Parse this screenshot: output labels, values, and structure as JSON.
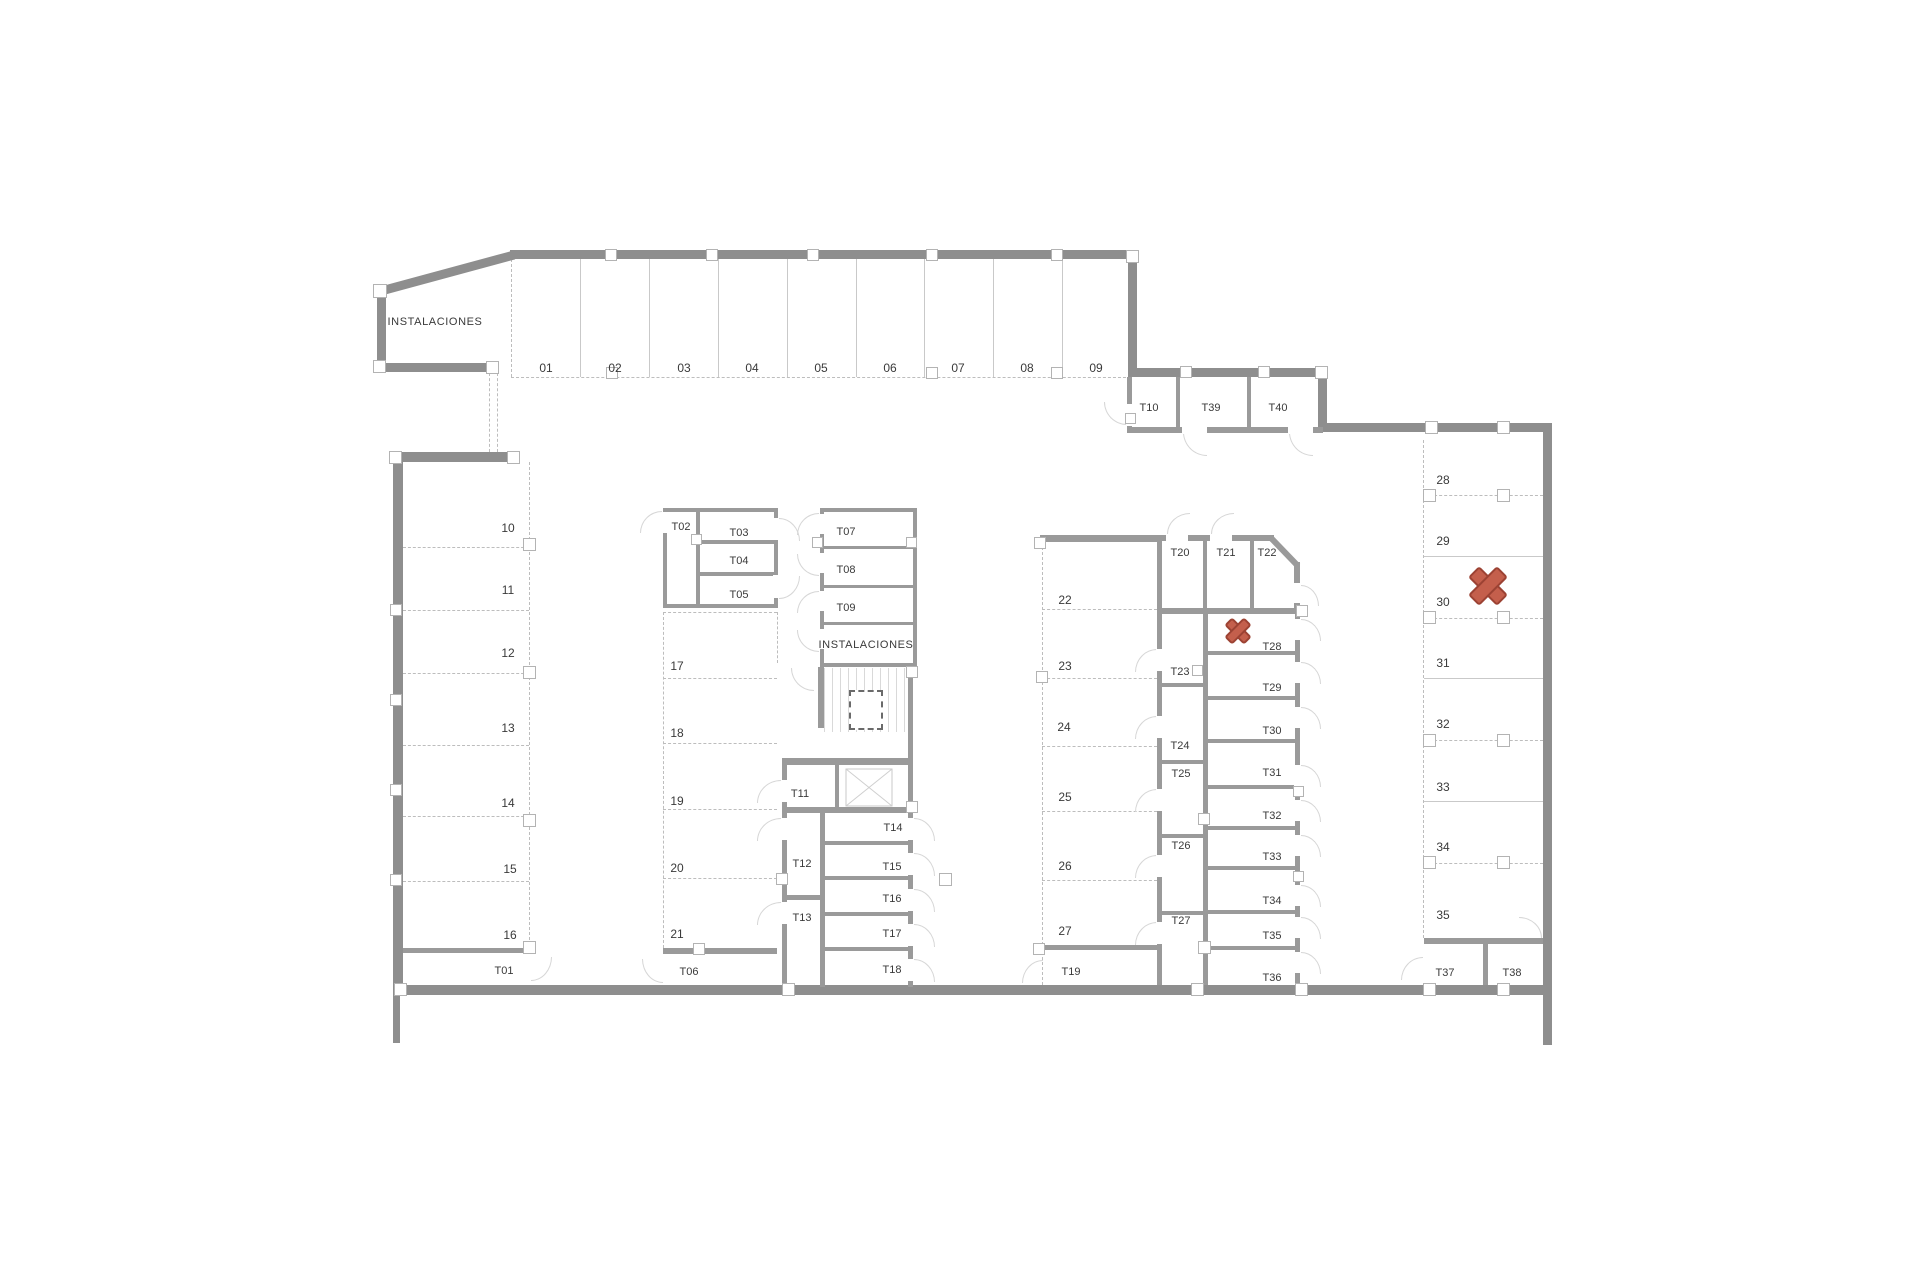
{
  "colors": {
    "wall": "#8e8e8e",
    "partition": "#9a9a9a",
    "dashed_line": "#bdbdbd",
    "divider": "#c9c9c9",
    "door_arc": "#d6d6d6",
    "text": "#3a3a3a",
    "marker_fill": "#c45f4c",
    "marker_stroke": "#9c4233"
  },
  "room_labels": [
    {
      "label": "INSTALACIONES",
      "x": 435,
      "y": 322
    },
    {
      "label": "INSTALACIONES",
      "x": 866,
      "y": 645
    }
  ],
  "parking_spaces": [
    {
      "id": "01",
      "x": 546,
      "y": 368
    },
    {
      "id": "02",
      "x": 615,
      "y": 368
    },
    {
      "id": "03",
      "x": 684,
      "y": 368
    },
    {
      "id": "04",
      "x": 752,
      "y": 368
    },
    {
      "id": "05",
      "x": 821,
      "y": 368
    },
    {
      "id": "06",
      "x": 890,
      "y": 368
    },
    {
      "id": "07",
      "x": 958,
      "y": 368
    },
    {
      "id": "08",
      "x": 1027,
      "y": 368
    },
    {
      "id": "09",
      "x": 1096,
      "y": 368
    },
    {
      "id": "10",
      "x": 508,
      "y": 528
    },
    {
      "id": "11",
      "x": 508,
      "y": 590
    },
    {
      "id": "12",
      "x": 508,
      "y": 653
    },
    {
      "id": "13",
      "x": 508,
      "y": 728
    },
    {
      "id": "14",
      "x": 508,
      "y": 803
    },
    {
      "id": "15",
      "x": 510,
      "y": 869
    },
    {
      "id": "16",
      "x": 510,
      "y": 935
    },
    {
      "id": "17",
      "x": 677,
      "y": 666
    },
    {
      "id": "18",
      "x": 677,
      "y": 733
    },
    {
      "id": "19",
      "x": 677,
      "y": 801
    },
    {
      "id": "20",
      "x": 677,
      "y": 868
    },
    {
      "id": "21",
      "x": 677,
      "y": 934
    },
    {
      "id": "22",
      "x": 1065,
      "y": 600
    },
    {
      "id": "23",
      "x": 1065,
      "y": 666
    },
    {
      "id": "24",
      "x": 1064,
      "y": 727
    },
    {
      "id": "25",
      "x": 1065,
      "y": 797
    },
    {
      "id": "26",
      "x": 1065,
      "y": 866
    },
    {
      "id": "27",
      "x": 1065,
      "y": 931
    },
    {
      "id": "28",
      "x": 1443,
      "y": 480
    },
    {
      "id": "29",
      "x": 1443,
      "y": 541
    },
    {
      "id": "30",
      "x": 1443,
      "y": 602
    },
    {
      "id": "31",
      "x": 1443,
      "y": 663
    },
    {
      "id": "32",
      "x": 1443,
      "y": 724
    },
    {
      "id": "33",
      "x": 1443,
      "y": 787
    },
    {
      "id": "34",
      "x": 1443,
      "y": 847
    },
    {
      "id": "35",
      "x": 1443,
      "y": 915
    }
  ],
  "storage_units": [
    {
      "id": "T01",
      "x": 504,
      "y": 971
    },
    {
      "id": "T02",
      "x": 681,
      "y": 527
    },
    {
      "id": "T03",
      "x": 739,
      "y": 533
    },
    {
      "id": "T04",
      "x": 739,
      "y": 561
    },
    {
      "id": "T05",
      "x": 739,
      "y": 595
    },
    {
      "id": "T06",
      "x": 689,
      "y": 972
    },
    {
      "id": "T07",
      "x": 846,
      "y": 532
    },
    {
      "id": "T08",
      "x": 846,
      "y": 570
    },
    {
      "id": "T09",
      "x": 846,
      "y": 608
    },
    {
      "id": "T10",
      "x": 1149,
      "y": 408
    },
    {
      "id": "T11",
      "x": 800,
      "y": 794
    },
    {
      "id": "T12",
      "x": 802,
      "y": 864
    },
    {
      "id": "T13",
      "x": 802,
      "y": 918
    },
    {
      "id": "T14",
      "x": 893,
      "y": 828
    },
    {
      "id": "T15",
      "x": 892,
      "y": 867
    },
    {
      "id": "T16",
      "x": 892,
      "y": 899
    },
    {
      "id": "T17",
      "x": 892,
      "y": 934
    },
    {
      "id": "T18",
      "x": 892,
      "y": 970
    },
    {
      "id": "T19",
      "x": 1071,
      "y": 972
    },
    {
      "id": "T20",
      "x": 1180,
      "y": 553
    },
    {
      "id": "T21",
      "x": 1226,
      "y": 553
    },
    {
      "id": "T22",
      "x": 1267,
      "y": 553
    },
    {
      "id": "T23",
      "x": 1180,
      "y": 672
    },
    {
      "id": "T24",
      "x": 1180,
      "y": 746
    },
    {
      "id": "T25",
      "x": 1181,
      "y": 774
    },
    {
      "id": "T26",
      "x": 1181,
      "y": 846
    },
    {
      "id": "T27",
      "x": 1181,
      "y": 921
    },
    {
      "id": "T28",
      "x": 1272,
      "y": 647
    },
    {
      "id": "T29",
      "x": 1272,
      "y": 688
    },
    {
      "id": "T30",
      "x": 1272,
      "y": 731
    },
    {
      "id": "T31",
      "x": 1272,
      "y": 773
    },
    {
      "id": "T32",
      "x": 1272,
      "y": 816
    },
    {
      "id": "T33",
      "x": 1272,
      "y": 857
    },
    {
      "id": "T34",
      "x": 1272,
      "y": 901
    },
    {
      "id": "T35",
      "x": 1272,
      "y": 936
    },
    {
      "id": "T36",
      "x": 1272,
      "y": 978
    },
    {
      "id": "T37",
      "x": 1445,
      "y": 973
    },
    {
      "id": "T38",
      "x": 1512,
      "y": 973
    },
    {
      "id": "T39",
      "x": 1211,
      "y": 408
    },
    {
      "id": "T40",
      "x": 1278,
      "y": 408
    }
  ],
  "markers": [
    {
      "type": "x-mark",
      "x": 1238,
      "y": 631,
      "size": 24
    },
    {
      "type": "x-mark",
      "x": 1488,
      "y": 586,
      "size": 36
    }
  ]
}
